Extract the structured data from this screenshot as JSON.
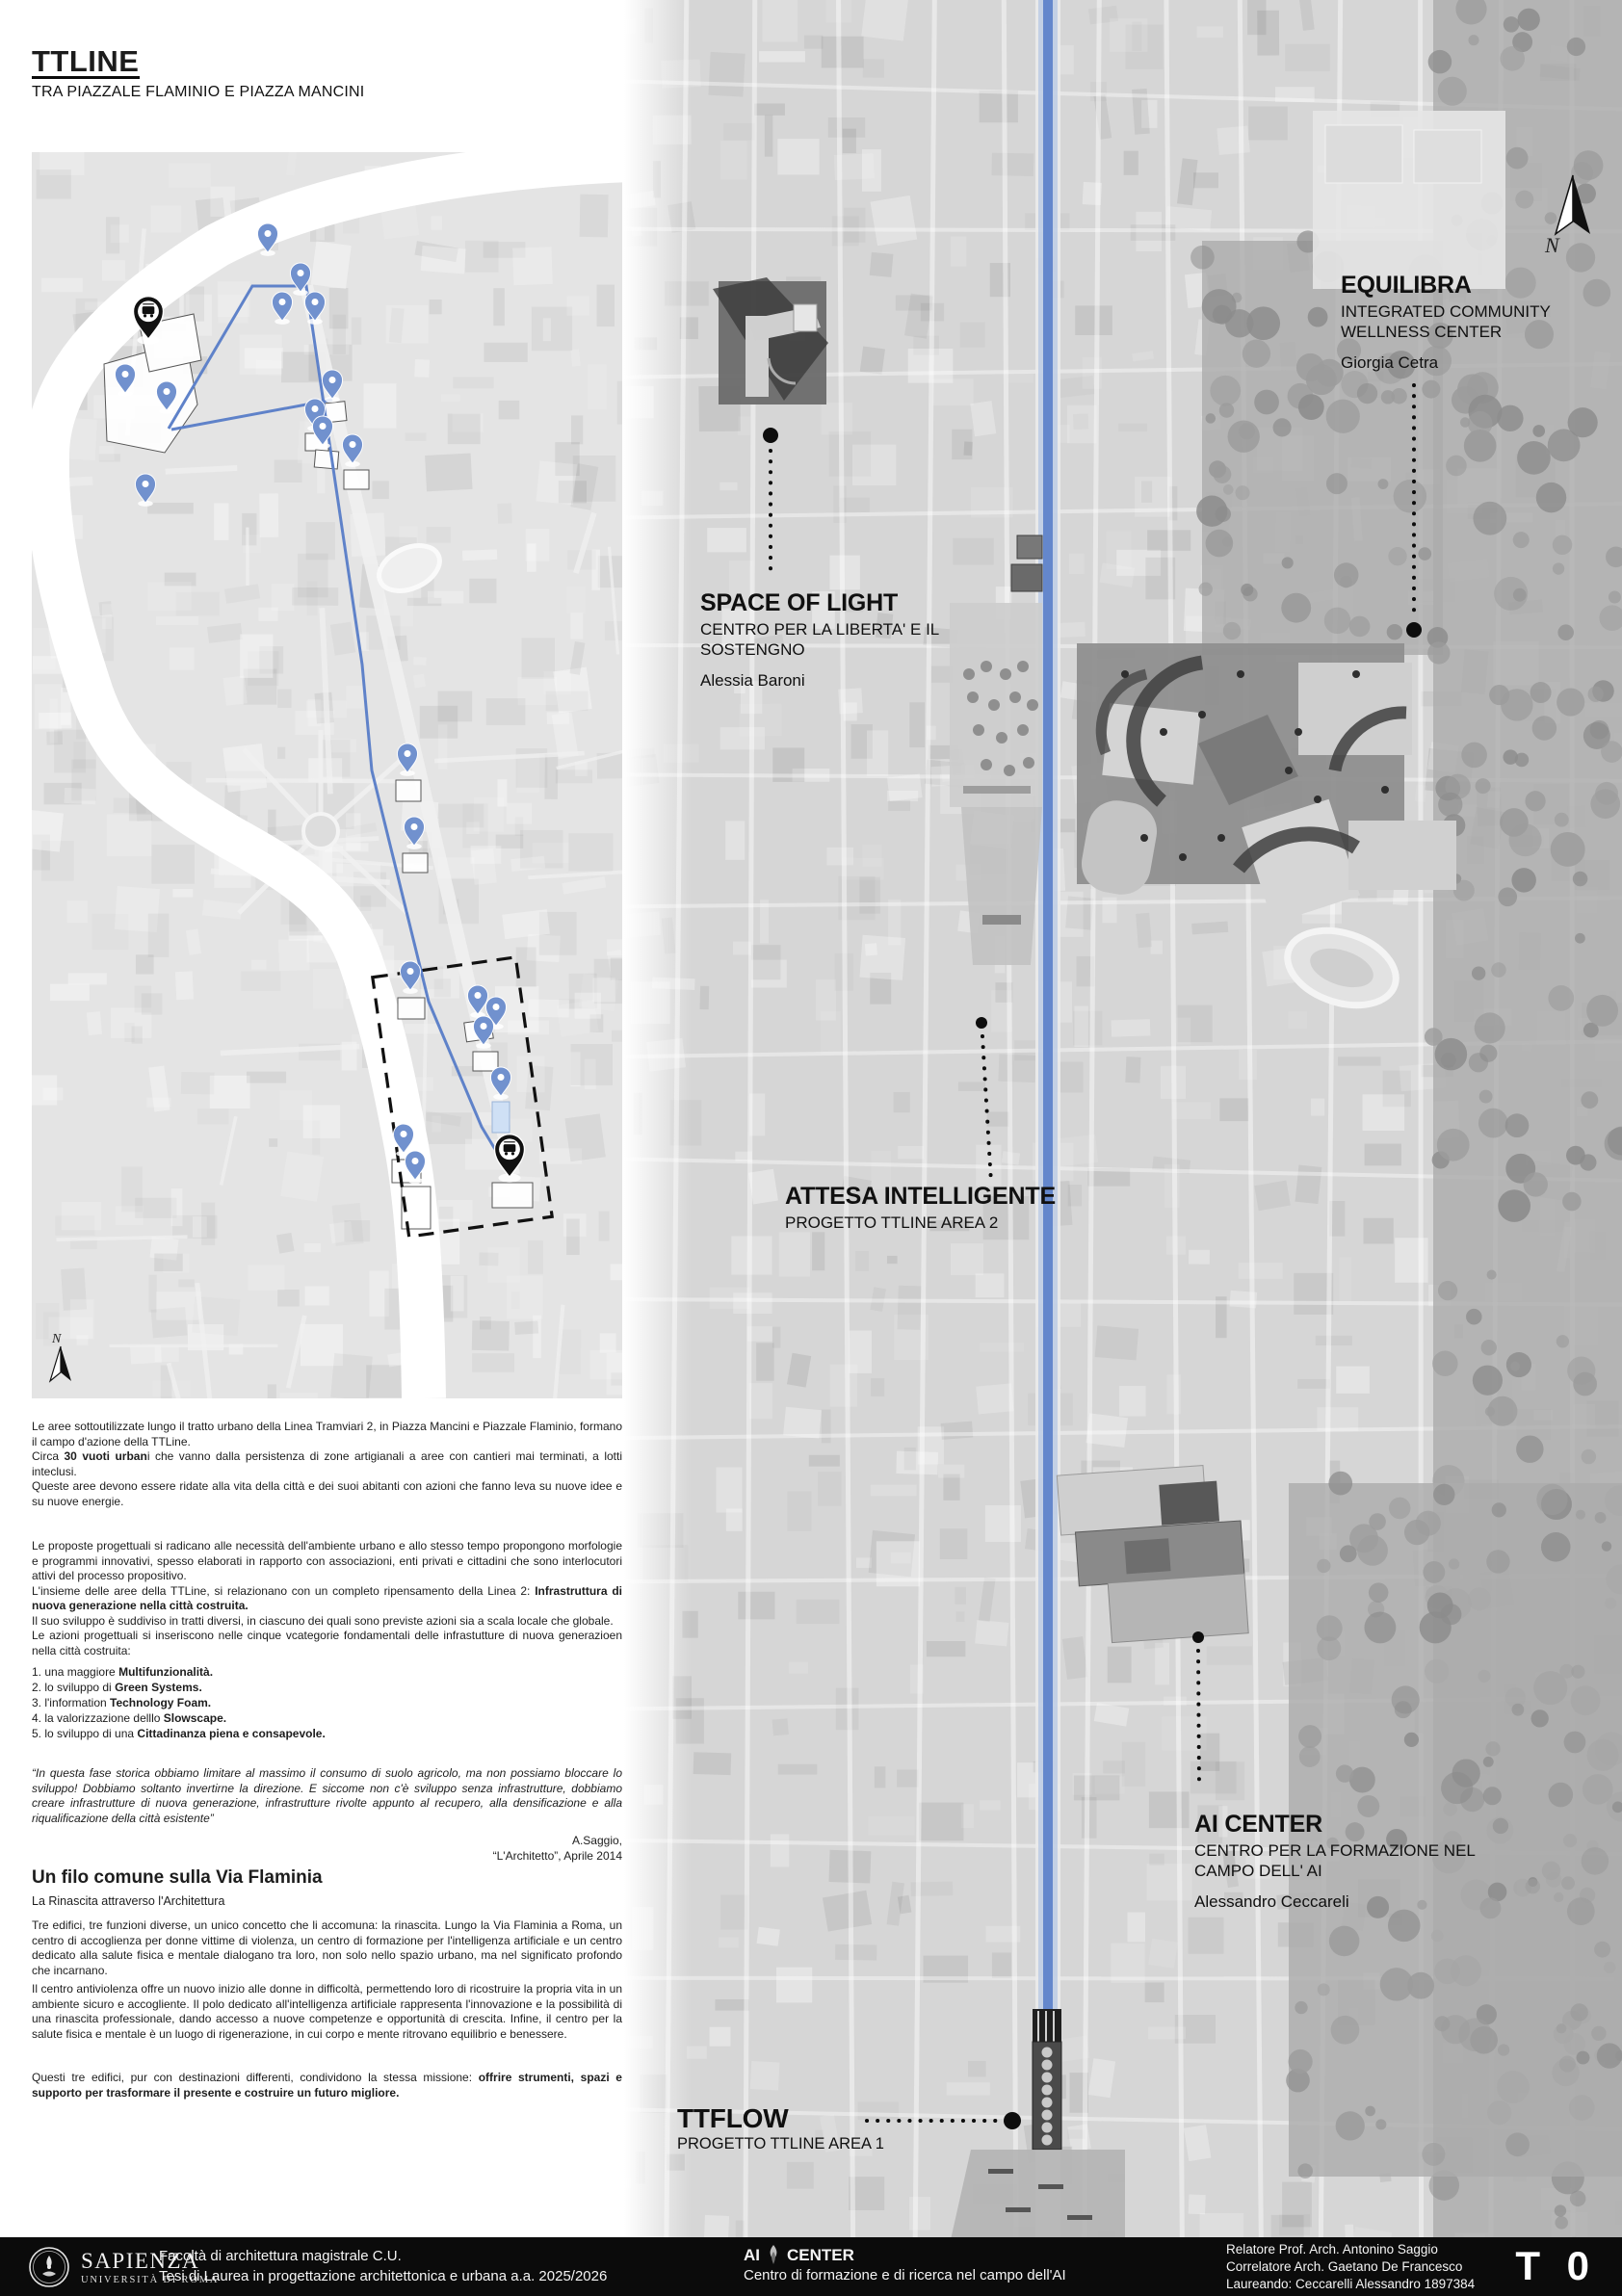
{
  "header": {
    "title": "TTLINE",
    "subtitle": "TRA PIAZZALE FLAMINIO E PIAZZA MANCINI"
  },
  "intro": {
    "p1": "Le aree sottoutilizzate lungo il tratto urbano della Linea Tramviari 2, in Piazza Mancini e Piazzale Flaminio, formano il campo d'azione della TTLine.",
    "p2_pre": "Circa ",
    "p2_bold": "30 vuoti urban",
    "p2_post": "i che vanno dalla persistenza di zone artigianali a aree con cantieri mai terminati, a lotti inteclusi.",
    "p3": "Queste aree devono essere ridate alla vita della città e dei suoi abitanti con azioni che fanno leva su nuove idee e su nuove energie."
  },
  "proposals": {
    "p1": "Le proposte progettuali si radicano alle necessità dell'ambiente urbano e allo stesso tempo propongono morfologie e programmi innovativi, spesso elaborati in rapporto con associazioni, enti privati e cittadini che sono interlocutori attivi del processo propositivo.",
    "p2_pre": "L'insieme delle aree della TTLine, si relazionano con un completo ripensamento della Linea 2: ",
    "p2_bold": "Infrastruttura di nuova generazione nella città costruita.",
    "p3": "Il suo sviluppo è suddiviso in tratti diversi, in ciascuno dei quali sono previste azioni sia a scala locale che globale.",
    "p4": "Le azioni progettuali si inseriscono nelle cinque vcategorie fondamentali delle infrastutture di nuova generazioen nella città costruita:"
  },
  "categories": [
    {
      "num": "1.",
      "pre": " una maggiore ",
      "bold": "Multifunzionalità."
    },
    {
      "num": "2.",
      "pre": " lo sviluppo di ",
      "bold": "Green Systems."
    },
    {
      "num": "3.",
      "pre": " l'information ",
      "bold": "Technology Foam."
    },
    {
      "num": "4.",
      "pre": " la valorizzazione delllo ",
      "bold": "Slowscape."
    },
    {
      "num": "5.",
      "pre": " lo sviluppo di una ",
      "bold": "Cittadinanza piena e consapevole."
    }
  ],
  "quote": {
    "text": "“In questa fase storica obbiamo limitare al massimo il consumo di suolo agricolo, ma non possiamo bloccare lo sviluppo! Dobbiamo soltanto invertirne la direzione. E siccome non c'è sviluppo senza infrastrutture, dobbiamo creare infrastrutture di nuova generazione, infrastrutture rivolte appunto al recupero, alla densificazione e alla riqualificazione della città esistente”",
    "author": "A.Saggio,",
    "source": "“L'Architetto”, Aprile 2014"
  },
  "essay": {
    "heading": "Un filo comune sulla Via Flaminia",
    "subheading": "La Rinascita attraverso l'Architettura",
    "p1": "Tre edifici, tre funzioni diverse, un unico concetto che li accomuna: la rinascita. Lungo la Via Flaminia a Roma, un centro di accoglienza per donne vittime di violenza, un centro di formazione per l'intelligenza artificiale e un centro dedicato alla salute fisica e mentale dialogano tra loro, non solo nello spazio urbano, ma nel significato profondo che incarnano.",
    "p2": "Il centro antiviolenza offre un nuovo inizio alle donne in difficoltà, permettendo loro di ricostruire la propria vita in un ambiente sicuro e accogliente. Il polo dedicato all'intelligenza artificiale rappresenta l'innovazione e la possibilità di una rinascita professionale, dando accesso a nuove competenze e opportunità di crescita. Infine, il centro per la salute fisica e mentale è un luogo di rigenerazione, in cui corpo e mente ritrovano equilibrio e benessere.",
    "p3_pre": "Questi tre edifici, pur con destinazioni differenti, condividono la stessa missione: ",
    "p3_bold": "offrire strumenti, spazi e supporto per trasformare il presente e costruire un futuro migliore."
  },
  "projects": {
    "equilibra": {
      "title": "EQUILIBRA",
      "subtitle": "INTEGRATED COMMUNITY WELLNESS CENTER",
      "author": "Giorgia Cetra"
    },
    "space_of_light": {
      "title": "SPACE OF LIGHT",
      "subtitle": "CENTRO PER LA LIBERTA' E IL SOSTENGNO",
      "author": "Alessia Baroni"
    },
    "attesa": {
      "title": "ATTESA INTELLIGENTE",
      "subtitle": "PROGETTO TTLINE AREA 2"
    },
    "ai_center": {
      "title": "AI CENTER",
      "subtitle": "CENTRO PER LA FORMAZIONE NEL CAMPO DELL' AI",
      "author": "Alessandro Ceccareli"
    },
    "ttflow": {
      "title": "TTFLOW",
      "subtitle": "PROGETTO TTLINE AREA 1"
    }
  },
  "compass": {
    "label": "N"
  },
  "map": {
    "route_color": "#5f82c9",
    "pin_color": "#7191ce",
    "pins": [
      [
        245,
        104
      ],
      [
        279,
        145
      ],
      [
        260,
        175
      ],
      [
        294,
        175
      ],
      [
        97,
        250
      ],
      [
        140,
        268
      ],
      [
        312,
        256
      ],
      [
        294,
        286
      ],
      [
        302,
        304
      ],
      [
        333,
        323
      ],
      [
        118,
        364
      ],
      [
        390,
        644
      ],
      [
        397,
        720
      ],
      [
        393,
        870
      ],
      [
        463,
        895
      ],
      [
        482,
        907
      ],
      [
        469,
        927
      ],
      [
        487,
        980
      ],
      [
        386,
        1039
      ],
      [
        398,
        1067
      ]
    ],
    "tram_pins": [
      [
        121,
        194
      ],
      [
        496,
        1064
      ]
    ]
  },
  "footer": {
    "university": {
      "name": "SAPIENZA",
      "sub": "UNIVERSITÀ DI ROMA"
    },
    "faculty_line1": "Facoltà di architettura magistrale C.U.",
    "faculty_line2": "Tesi di Laurea in progettazione architettonica e urbana a.a. 2025/2026",
    "project_title_pre": "AI",
    "project_title_post": "CENTER",
    "project_subtitle": "Centro di formazione e di ricerca nel campo dell'AI",
    "credit_line1": "Relatore Prof. Arch. Antonino Saggio",
    "credit_line2": "Correlatore Arch. Gaetano De Francesco",
    "credit_line3": "Laureando: Ceccarelli Alessandro  1897384",
    "tavola": "T 0"
  }
}
